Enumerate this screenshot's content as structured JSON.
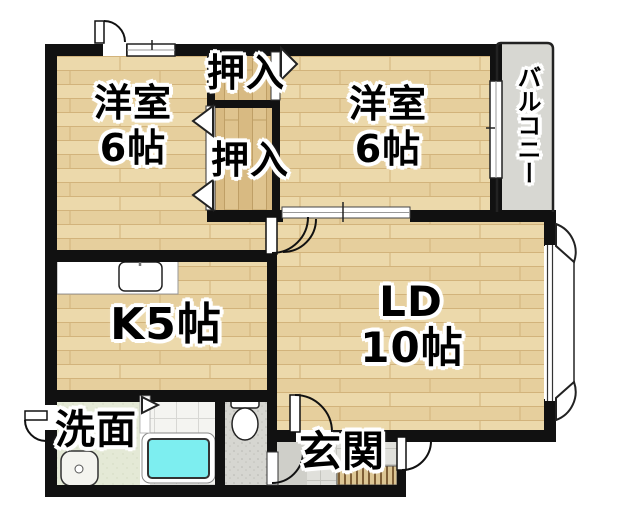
{
  "plan": {
    "type": "apartment-floor-plan",
    "rooms": {
      "bedroom_left": {
        "name": "洋室",
        "size": "6帖"
      },
      "bedroom_right": {
        "name": "洋室",
        "size": "6帖"
      },
      "closet_top": {
        "name": "押入"
      },
      "closet_bottom": {
        "name": "押入"
      },
      "balcony": {
        "name": "バルコニー"
      },
      "kitchen": {
        "name": "K5帖"
      },
      "living_dining": {
        "name": "LD",
        "size": "10帖"
      },
      "washroom": {
        "name": "洗面"
      },
      "entrance": {
        "name": "玄関"
      }
    },
    "fixtures": [
      "kitchen-sink-icon",
      "bathtub-icon",
      "toilet-icon",
      "washbasin-icon"
    ],
    "colors": {
      "wall": "#111111",
      "wood": "#ecd9ab",
      "closet_wood": "#dfc48f",
      "balcony_floor": "#d7d7d2",
      "washroom_floor": "#e4e9d6",
      "bath_tile": "#f4f4f1",
      "toilet_floor": "#d6d6d1",
      "entrance_tile": "#e0e0db",
      "entrance_step": "#dcc694",
      "bathtub": "#7deef0"
    }
  }
}
